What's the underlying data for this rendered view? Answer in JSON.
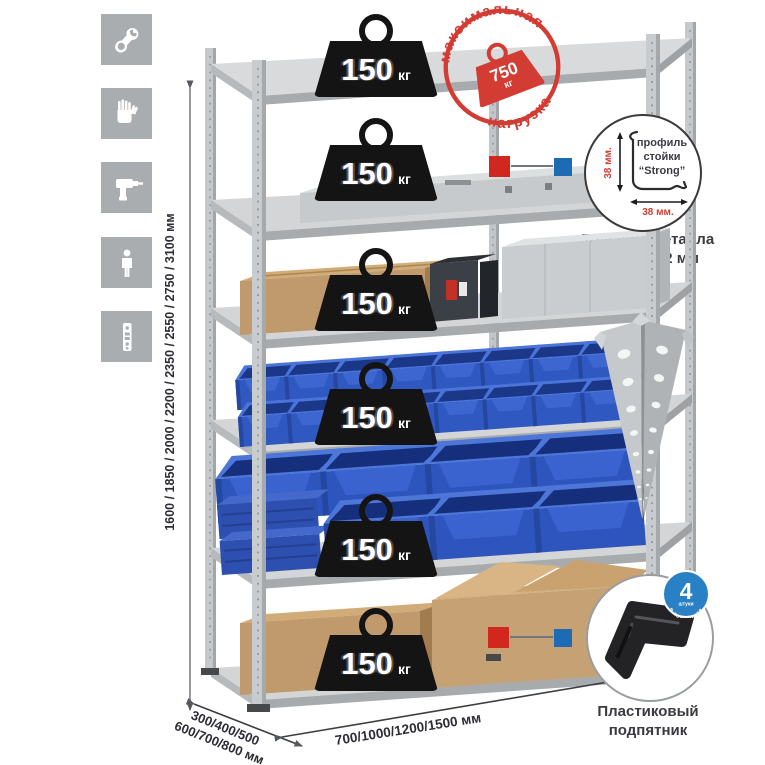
{
  "meta": {
    "description": "Product infographic of a bolted metal shelving rack"
  },
  "colors": {
    "icon_gray": "#a9adb0",
    "accent_red": "#d2271f",
    "accent_blue": "#1d6ab5",
    "stamp_red": "#d23c33",
    "weight_black": "#141414",
    "bin_blue": "#2e55be",
    "cardboard": "#c09a6c",
    "metal_gray": "#c6c9cb"
  },
  "sidebar": {
    "icons": [
      {
        "name": "wrench-icon"
      },
      {
        "name": "gloves-icon"
      },
      {
        "name": "drill-icon"
      },
      {
        "name": "person-icon"
      },
      {
        "name": "perforated-post-icon"
      }
    ]
  },
  "rack": {
    "shelf_count": 6,
    "shelves": [
      {
        "load": "150",
        "unit": "кг"
      },
      {
        "load": "150",
        "unit": "кг"
      },
      {
        "load": "150",
        "unit": "кг"
      },
      {
        "load": "150",
        "unit": "кг"
      },
      {
        "load": "150",
        "unit": "кг"
      },
      {
        "load": "150",
        "unit": "кг"
      }
    ]
  },
  "stamp": {
    "arc_top": "максимальная",
    "arc_bottom": "нагрузка",
    "value": "750",
    "unit": "кг"
  },
  "profile_detail": {
    "line1": "профиль",
    "line2": "стойки",
    "line3": "“Strong”",
    "dim_vertical": "38 мм.",
    "dim_horizontal": "38 мм.",
    "caption1": "Толщина металла",
    "caption2": "стойки 1,2 мм"
  },
  "foot_detail": {
    "badge_number": "4",
    "badge_sub": "штуки",
    "badge_arc": "в комплекте",
    "caption1": "Пластиковый",
    "caption2": "подпятник"
  },
  "dimensions": {
    "height": "1600 / 1850 / 2000 / 2200 / 2350 / 2550 / 2750 / 3100 мм",
    "depth_line1": "300/400/500",
    "depth_line2": "600/700/800 мм",
    "width": "700/1000/1200/1500 мм"
  }
}
